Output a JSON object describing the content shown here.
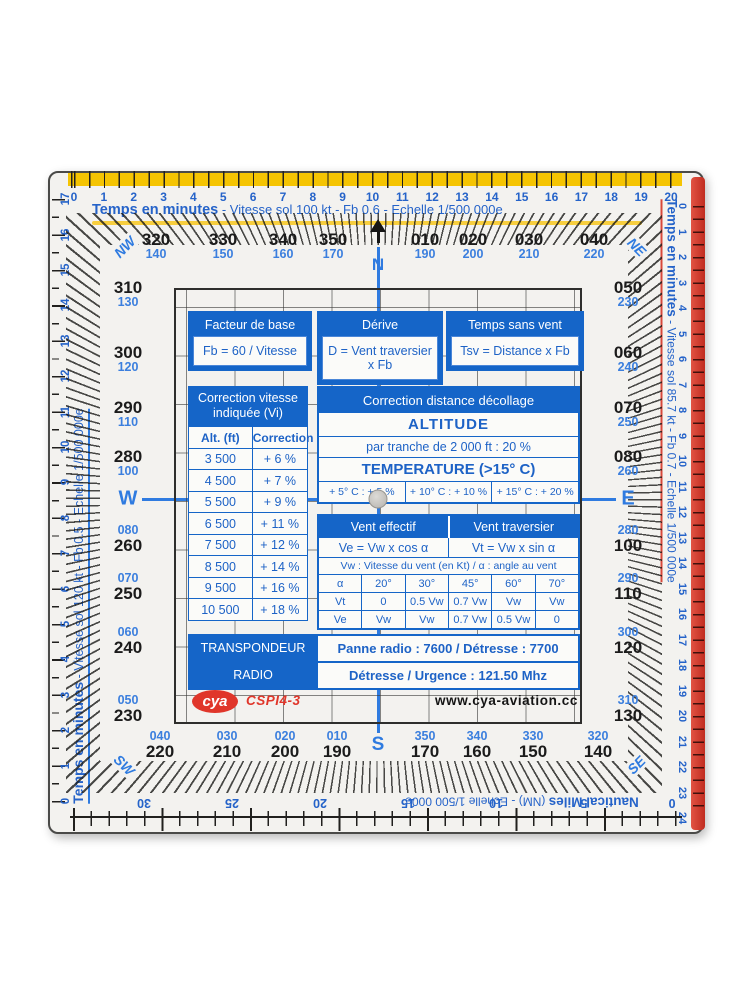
{
  "colors": {
    "accent_blue": "#1565c8",
    "number_blue": "#2563c9",
    "band_yellow": "#f5c402",
    "band_red": "#c8362a",
    "logo_red": "#e0362a"
  },
  "top_ruler": {
    "title": "Temps en minutes",
    "subtitle": "- Vitesse sol  100 kt - Fb  0.6 - Echelle  1/500 000e",
    "numbers": [
      "0",
      "1",
      "2",
      "3",
      "4",
      "5",
      "6",
      "7",
      "8",
      "9",
      "10",
      "11",
      "12",
      "13",
      "14",
      "15",
      "16",
      "17",
      "18",
      "19",
      "20"
    ]
  },
  "left_ruler": {
    "title": "Temps en minutes",
    "subtitle": "- Vitesse sol  120 kt - Fb  0.5 - Echelle  1/500 000e",
    "numbers": [
      "0",
      "1",
      "2",
      "3",
      "4",
      "5",
      "6",
      "7",
      "8",
      "9",
      "10",
      "11",
      "12",
      "13",
      "14",
      "15",
      "16",
      "17"
    ]
  },
  "right_ruler": {
    "title": "Temps en minutes",
    "subtitle": "- Vitesse sol  85.7 kt - Fb  0.7 - Echelle  1/500 000e",
    "numbers": [
      "0",
      "1",
      "2",
      "3",
      "4",
      "5",
      "6",
      "7",
      "8",
      "9",
      "10",
      "11",
      "12",
      "13",
      "14",
      "15",
      "16",
      "17",
      "18",
      "19",
      "20",
      "21",
      "22",
      "23",
      "24"
    ]
  },
  "bottom_ruler": {
    "title": "Nautical Miles",
    "subtitle": "(NM) - Echelle  1/500 000e",
    "numbers": [
      "30",
      "25",
      "20",
      "15",
      "10",
      "5",
      "0"
    ]
  },
  "compass": {
    "n": "N",
    "s": "S",
    "w": "W",
    "e": "E",
    "nw": "NW",
    "ne": "NE",
    "sw": "SW",
    "se": "SE",
    "top": [
      {
        "b": "320",
        "s": "140"
      },
      {
        "b": "330",
        "s": "150"
      },
      {
        "b": "340",
        "s": "160"
      },
      {
        "b": "350",
        "s": "170"
      },
      {
        "b": "010",
        "s": "190"
      },
      {
        "b": "020",
        "s": "200"
      },
      {
        "b": "030",
        "s": "210"
      },
      {
        "b": "040",
        "s": "220"
      }
    ],
    "bottom": [
      {
        "b": "220",
        "s": "040"
      },
      {
        "b": "210",
        "s": "030"
      },
      {
        "b": "200",
        "s": "020"
      },
      {
        "b": "190",
        "s": "010"
      },
      {
        "b": "170",
        "s": "350"
      },
      {
        "b": "160",
        "s": "340"
      },
      {
        "b": "150",
        "s": "330"
      },
      {
        "b": "140",
        "s": "320"
      }
    ],
    "left": [
      {
        "b": "310",
        "s": "130"
      },
      {
        "b": "300",
        "s": "120"
      },
      {
        "b": "290",
        "s": "110"
      },
      {
        "b": "280",
        "s": "100"
      },
      {
        "b": "260",
        "s": "080"
      },
      {
        "b": "250",
        "s": "070"
      },
      {
        "b": "240",
        "s": "060"
      },
      {
        "b": "230",
        "s": "050"
      }
    ],
    "right": [
      {
        "b": "050",
        "s": "230"
      },
      {
        "b": "060",
        "s": "240"
      },
      {
        "b": "070",
        "s": "250"
      },
      {
        "b": "080",
        "s": "260"
      },
      {
        "b": "100",
        "s": "280"
      },
      {
        "b": "110",
        "s": "290"
      },
      {
        "b": "120",
        "s": "300"
      },
      {
        "b": "130",
        "s": "310"
      }
    ]
  },
  "formula_boxes": [
    {
      "title": "Facteur de base",
      "body": "Fb = 60 / Vitesse"
    },
    {
      "title": "Dérive",
      "body": "D = Vent traversier x Fb"
    },
    {
      "title": "Temps sans vent",
      "body": "Tsv = Distance x Fb"
    }
  ],
  "correction_vitesse": {
    "title": "Correction vitesse indiquée (Vi)",
    "headers": [
      "Alt. (ft)",
      "Correction"
    ],
    "rows": [
      {
        "alt": "3 500",
        "corr": "+ 6 %"
      },
      {
        "alt": "4 500",
        "corr": "+ 7 %"
      },
      {
        "alt": "5 500",
        "corr": "+ 9 %"
      },
      {
        "alt": "6 500",
        "corr": "+ 11 %"
      },
      {
        "alt": "7 500",
        "corr": "+ 12 %"
      },
      {
        "alt": "8 500",
        "corr": "+ 14 %"
      },
      {
        "alt": "9 500",
        "corr": "+ 16 %"
      },
      {
        "alt": "10 500",
        "corr": "+ 18 %"
      }
    ]
  },
  "correction_distance": {
    "title": "Correction distance décollage",
    "altitude": "ALTITUDE",
    "altitude_rule": "par tranche de 2 000 ft : 20 %",
    "temperature": "TEMPERATURE (>15° C)",
    "temp_cells": [
      "+ 5° C : + 5 %",
      "+ 10° C : + 10 %",
      "+ 15° C : + 20 %"
    ]
  },
  "vent": {
    "eff_title": "Vent effectif",
    "trav_title": "Vent traversier",
    "eff_formula": "Ve = Vw x cos α",
    "trav_formula": "Vt = Vw x sin α",
    "note": "Vw : Vitesse du vent (en Kt) / α : angle au vent",
    "angle_row": [
      "α",
      "20°",
      "30°",
      "45°",
      "60°",
      "70°"
    ],
    "vt_row": [
      "Vt",
      "0",
      "0.5 Vw",
      "0.7 Vw",
      "Vw",
      "Vw"
    ],
    "ve_row": [
      "Ve",
      "Vw",
      "Vw",
      "0.7 Vw",
      "0.5 Vw",
      "0"
    ]
  },
  "radio": {
    "rows": [
      {
        "label": "TRANSPONDEUR",
        "value": "Panne radio : 7600 / Détresse : 7700"
      },
      {
        "label": "RADIO",
        "value": "Détresse / Urgence : 121.50 Mhz"
      }
    ]
  },
  "branding": {
    "logo": "cya",
    "model": "CSPI4-3",
    "website": "www.cya-aviation.cc"
  }
}
